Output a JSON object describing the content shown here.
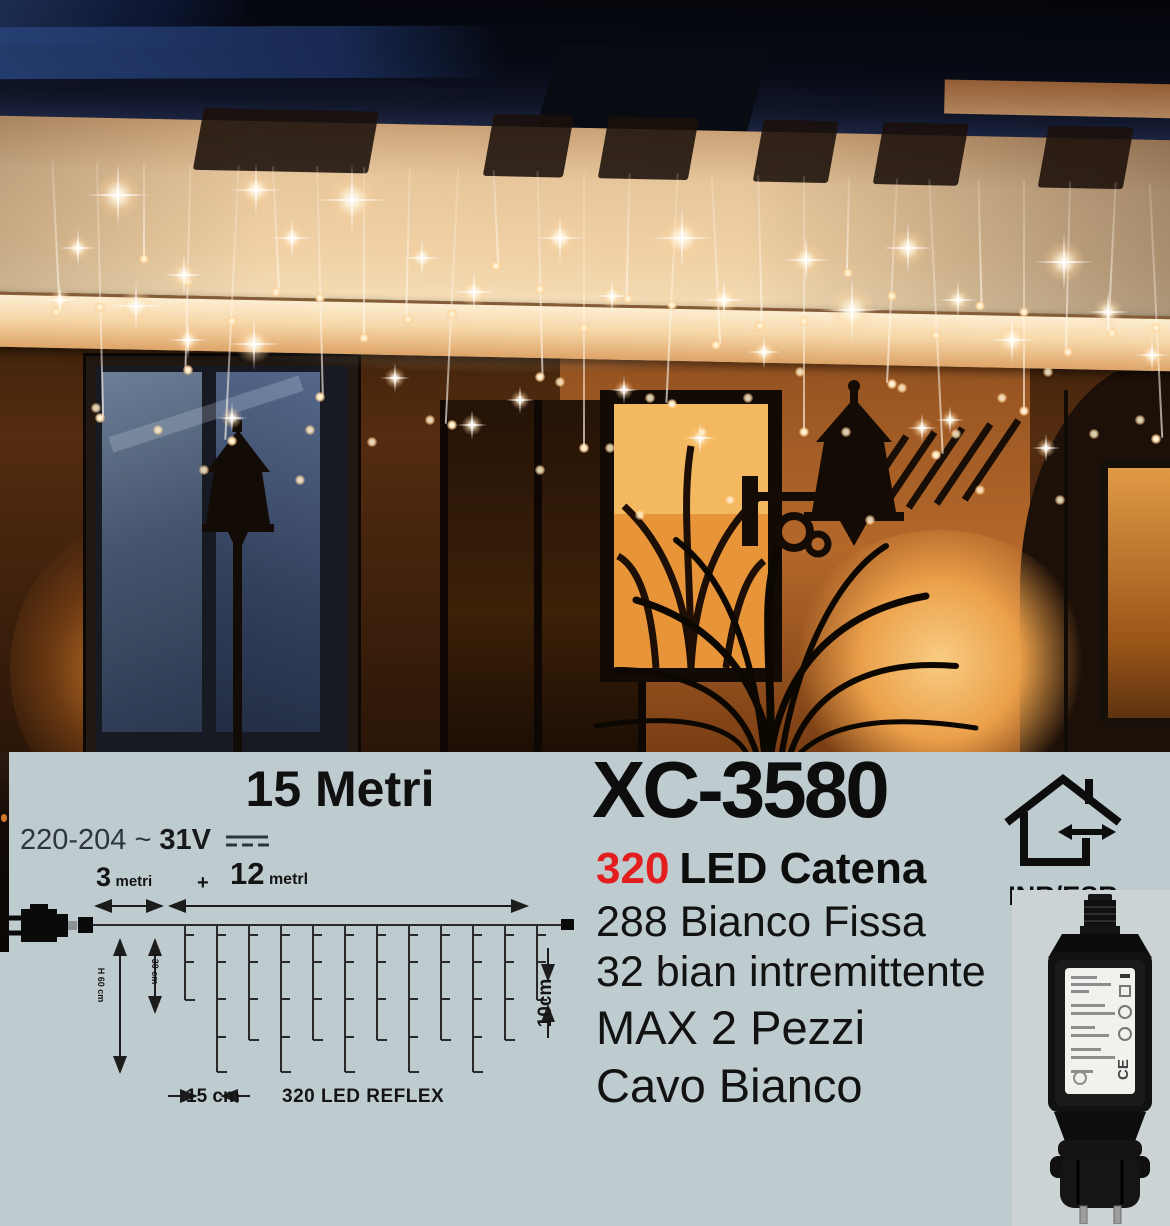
{
  "panel": {
    "length_title": "15 Metri",
    "voltage_prefix": "220-204 ~",
    "voltage_value": "31V"
  },
  "product": {
    "code": "XC-3580",
    "led_count": "320",
    "led_type": "LED Catena",
    "line1": "288 Bianco Fissa",
    "line2": "32 bian intremittente",
    "line3": "MAX 2 Pezzi",
    "line4": "Cavo Bianco"
  },
  "diagram": {
    "seg1_value": "3",
    "seg1_unit": "metri",
    "plus": "+",
    "seg2_value": "12",
    "seg2_unit": "metrl",
    "height_long": "H 60 cm",
    "height_short": "H 30 cm",
    "end_gap": "10cm",
    "spacing": "15 cm",
    "led_note": "320 LED REFLEX"
  },
  "usage": {
    "rating_label": "INR/ESR"
  },
  "colors": {
    "panel_bg": "#bfcccf",
    "accent_red": "#e31e1e",
    "text": "#111111",
    "warm_light": "#f0d0a4"
  }
}
